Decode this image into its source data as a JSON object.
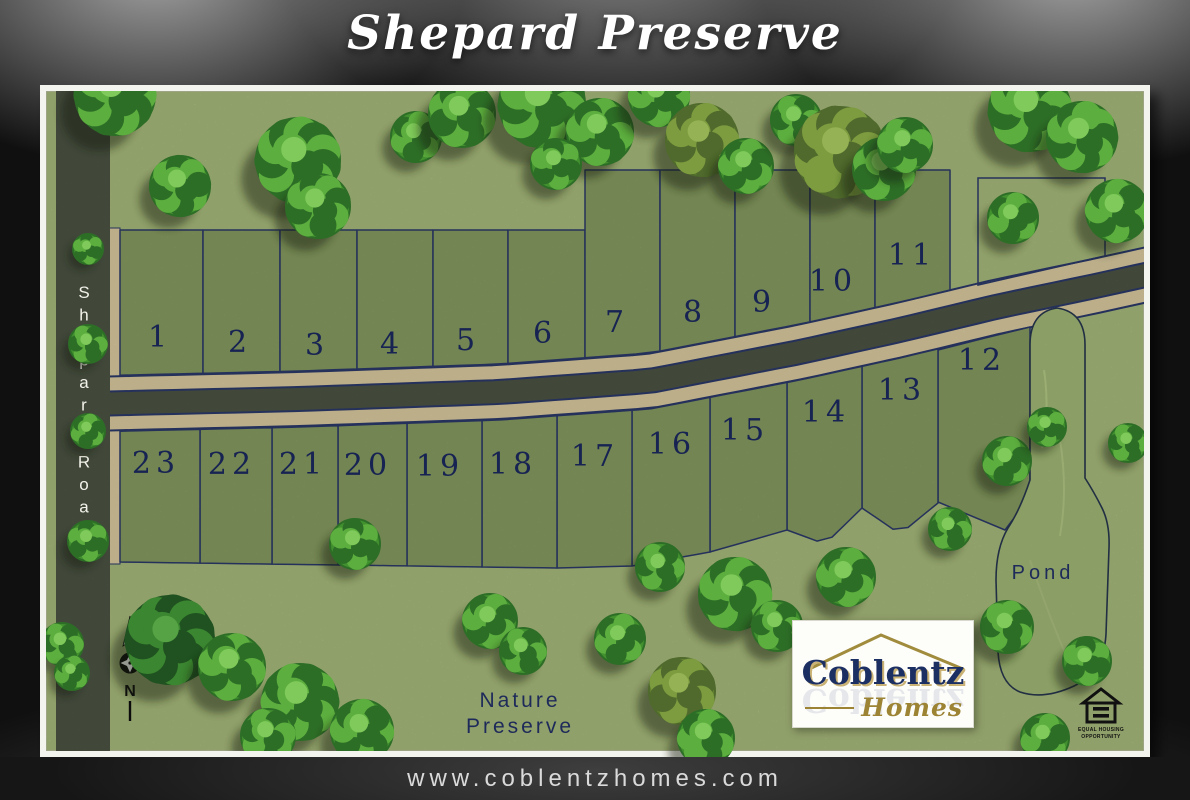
{
  "title": "Shepard Preserve",
  "map": {
    "shepard_road_label": "Shepard Road",
    "lots": [
      "1",
      "2",
      "3",
      "4",
      "5",
      "6",
      "7",
      "8",
      "9",
      "10",
      "11",
      "12",
      "13",
      "14",
      "15",
      "16",
      "17",
      "18",
      "19",
      "20",
      "21",
      "22",
      "23"
    ],
    "pond_label": "Pond",
    "nature_preserve": {
      "line1": "Nature",
      "line2": "Preserve"
    },
    "north_label": "N"
  },
  "logo": {
    "name": "Coblentz",
    "sub": "Homes"
  },
  "equal_housing": {
    "line1": "EQUAL HOUSING",
    "line2": "OPPORTUNITY"
  },
  "footer": {
    "url": "www.coblentzhomes.com"
  },
  "colors": {
    "grass": "#a9bc7d",
    "lot_green": "#879c61",
    "pond_green": "#a2b977",
    "road_asphalt": "#4d5544",
    "road_shoulder": "#dbcca1",
    "outline_navy": "#2c3a6b",
    "label_navy": "#1b2960",
    "logo_navy": "#1c2f63",
    "logo_gold": "#9c8434",
    "frame_white": "#f4f4ee"
  }
}
